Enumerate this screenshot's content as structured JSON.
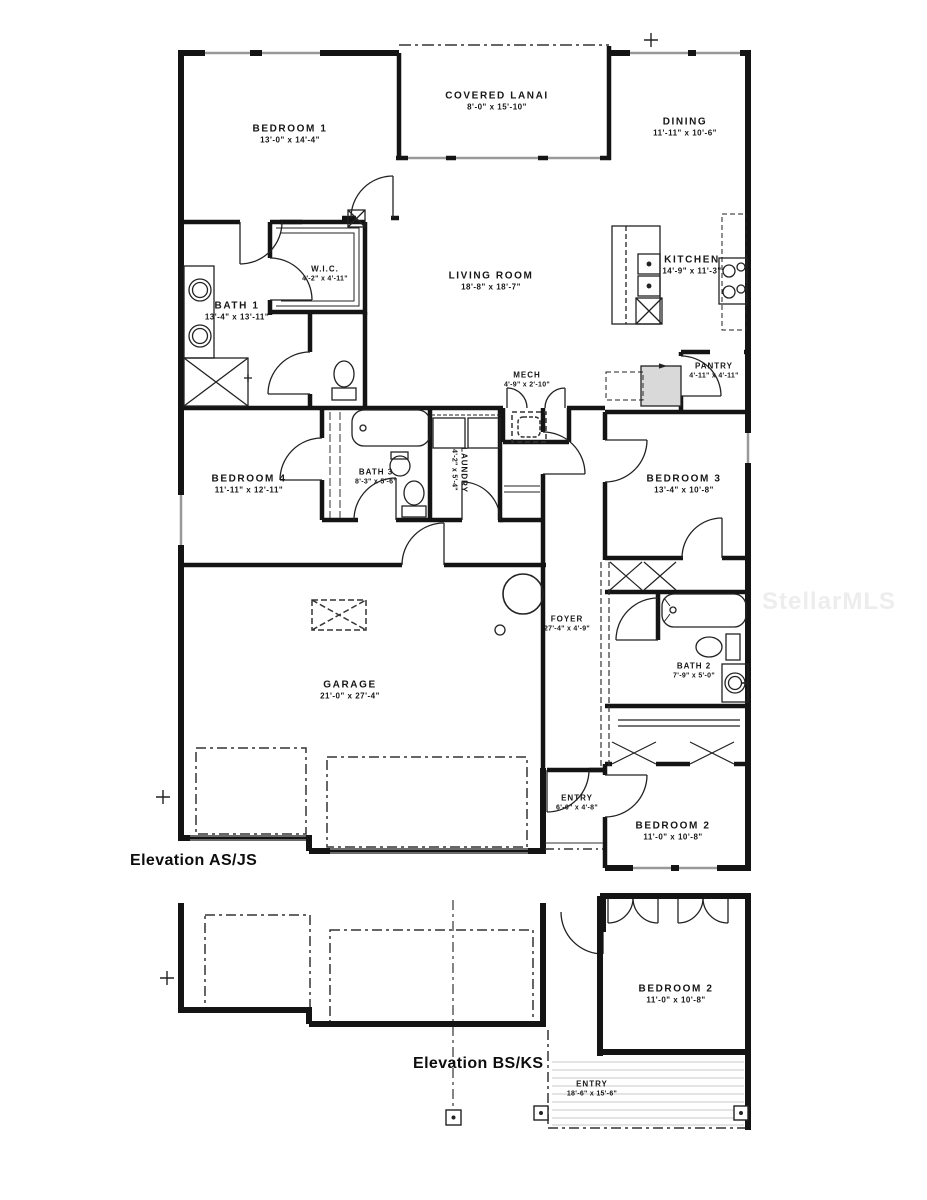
{
  "watermark": "StellarMLS",
  "colors": {
    "wall": "#141414",
    "window_glass": "#999999",
    "watermark": "#ededed"
  },
  "plans": {
    "main": {
      "elevation_label": "Elevation AS/JS",
      "rooms": {
        "bedroom1": {
          "name": "BEDROOM 1",
          "dims": "13'-0\" x 14'-4\""
        },
        "lanai": {
          "name": "COVERED LANAI",
          "dims": "8'-0\" x 15'-10\""
        },
        "dining": {
          "name": "DINING",
          "dims": "11'-11\" x 10'-6\""
        },
        "wic": {
          "name": "W.I.C.",
          "dims": "4'-2\" x 4'-11\""
        },
        "living": {
          "name": "LIVING ROOM",
          "dims": "18'-8\" x 18'-7\""
        },
        "kitchen": {
          "name": "KITCHEN",
          "dims": "14'-9\" x 11'-3\""
        },
        "bath1": {
          "name": "BATH 1",
          "dims": "13'-4\" x 13'-11\""
        },
        "mech": {
          "name": "MECH",
          "dims": "4'-9\" x 2'-10\""
        },
        "pantry": {
          "name": "PANTRY",
          "dims": "4'-11\" x 4'-11\""
        },
        "bedroom4": {
          "name": "BEDROOM 4",
          "dims": "11'-11\" x 12'-11\""
        },
        "bath3": {
          "name": "BATH 3",
          "dims": "8'-3\" x 5'-6\""
        },
        "laundry": {
          "name": "LAUNDRY",
          "dims": "4'-2\" x 5'-4\""
        },
        "bedroom3": {
          "name": "BEDROOM 3",
          "dims": "13'-4\" x 10'-8\""
        },
        "foyer": {
          "name": "FOYER",
          "dims": "27'-4\" x 4'-9\""
        },
        "garage": {
          "name": "GARAGE",
          "dims": "21'-0\" x 27'-4\""
        },
        "bath2": {
          "name": "BATH 2",
          "dims": "7'-9\" x 5'-0\""
        },
        "entry": {
          "name": "ENTRY",
          "dims": "6'-0\" x 4'-8\""
        },
        "bedroom2": {
          "name": "BEDROOM 2",
          "dims": "11'-0\" x 10'-8\""
        }
      }
    },
    "alt": {
      "elevation_label": "Elevation BS/KS",
      "rooms": {
        "bedroom2": {
          "name": "BEDROOM 2",
          "dims": "11'-0\" x 10'-8\""
        },
        "entry": {
          "name": "ENTRY",
          "dims": "18'-6\" x 15'-6\""
        }
      }
    }
  }
}
